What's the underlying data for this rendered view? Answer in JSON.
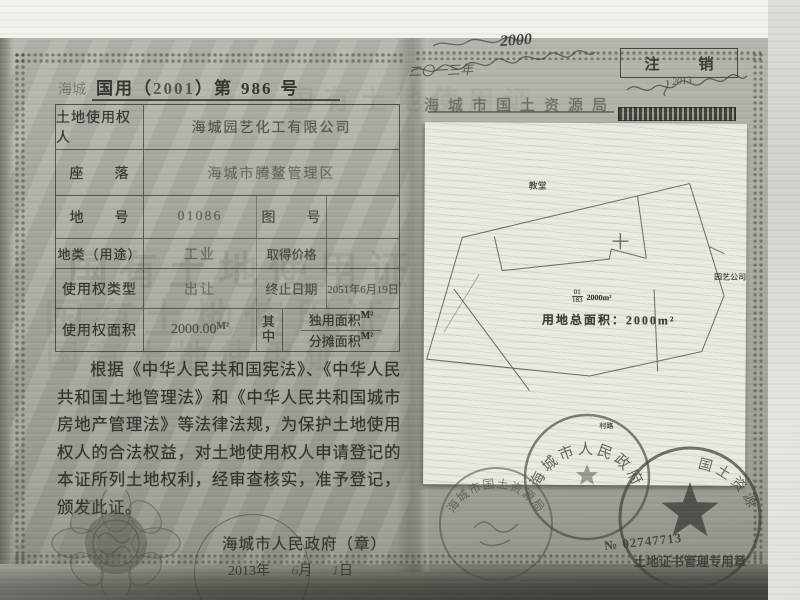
{
  "watermark": {
    "text": "国有土地使用证"
  },
  "left_page": {
    "header": {
      "prefix": "海城",
      "part1": "国用（",
      "year": "2001",
      "part2": "）第",
      "number": "986",
      "part3": "号"
    },
    "table": {
      "r1_label": "土地使用权人",
      "r1_value": "海城园艺化工有限公司",
      "r2_label": "座　　落",
      "r2_value": "海城市腾鳌管理区",
      "r3_label": "地　　号",
      "r3_value": "01086",
      "r3_label2": "图　　号",
      "r3_value2": "",
      "r4_label": "地类（用途）",
      "r4_value": "工业",
      "r4_label2": "取得价格",
      "r4_value2": "",
      "r5_label": "使用权类型",
      "r5_value": "出让",
      "r5_label2": "终止日期",
      "r5_value2": "2051年6月19日",
      "r6_label": "使用权面积",
      "r6_value": "2000.00",
      "r6_unit": "M²",
      "r6_mid": "其中",
      "r6_sub1": "独用面积",
      "r6_sub1_unit": "M²",
      "r6_sub2": "分摊面积",
      "r6_sub2_unit": "M²"
    },
    "statement": "根据《中华人民共和国宪法》、《中华人民共和国土地管理法》和《中华人民共和国城市房地产管理法》等法律法规，为保护土地使用权人的合法权益，对土地使用权人申请登记的本证所列土地权利，经审查核实，准予登记，颁发此证。",
    "issuer": "海城市人民政府（章）",
    "date": {
      "year": "2013",
      "y": "年",
      "month": "6",
      "m": "月",
      "day": "1",
      "d": "日"
    }
  },
  "right_page": {
    "hand_top": "2000",
    "cancel": "注　销",
    "hand_mid": "二〇一三年",
    "hand_right": "2013",
    "bureau": "海城市国土资源局"
  },
  "site_plan": {
    "church": "教堂",
    "company": "园艺公司",
    "road": "村路",
    "parcel_top": "01",
    "parcel_bottom": "183",
    "parcel_area": "2000m²",
    "total_area": "用地总面积：2000m²"
  },
  "seals": {
    "gov": "海城市人民政府",
    "star_arc": "国土资源",
    "star_caption": "土地证书管理专用章",
    "bureau_arc": "海城市国土资源局",
    "serial": "№ 02747713"
  }
}
